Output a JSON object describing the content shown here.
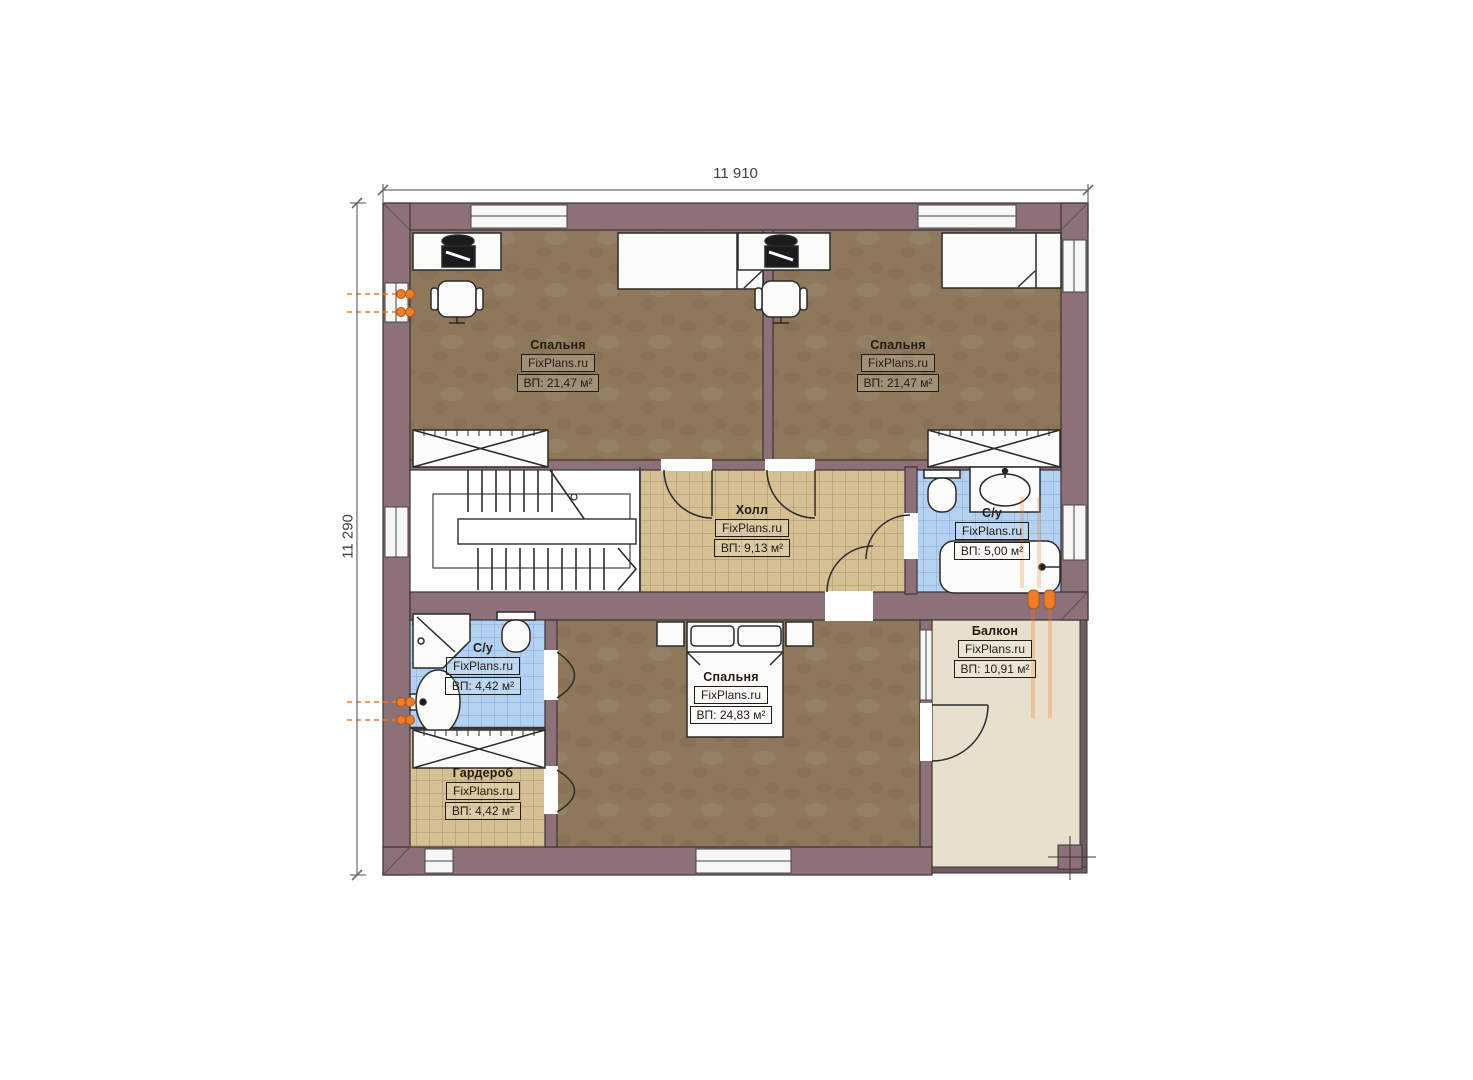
{
  "plan": {
    "brand": "FixPlans.ru",
    "dimensions": {
      "width_mm": "11 910",
      "height_mm": "11 290"
    },
    "rooms": [
      {
        "id": "bedroom-top-left",
        "name": "Спальня",
        "area": "ВП: 21,47 м²"
      },
      {
        "id": "bedroom-top-right",
        "name": "Спальня",
        "area": "ВП: 21,47 м²"
      },
      {
        "id": "hall",
        "name": "Холл",
        "area": "ВП: 9,13 м²"
      },
      {
        "id": "bathroom-top",
        "name": "С/у",
        "area": "ВП: 5,00 м²"
      },
      {
        "id": "bathroom-bottom",
        "name": "С/у",
        "area": "ВП: 4,42 м²"
      },
      {
        "id": "bedroom-bottom",
        "name": "Спальня",
        "area": "ВП: 24,83 м²"
      },
      {
        "id": "wardrobe",
        "name": "Гардероб",
        "area": "ВП: 4,42 м²"
      },
      {
        "id": "balcony",
        "name": "Балкон",
        "area": "ВП: 10,91 м²"
      }
    ]
  },
  "colors": {
    "wall": "#8c7278",
    "outline": "#3a3434",
    "bedroom_floor": "#8d785b",
    "hall_floor": "#d5c094",
    "tile_line_tan": "#a5906a",
    "bathroom_floor": "#b3d1f1",
    "tile_line_blue": "#7fa9d9",
    "balcony_floor": "#e8e0cc",
    "radiator": "#ed7d2b",
    "label_ink": "#241c12"
  }
}
